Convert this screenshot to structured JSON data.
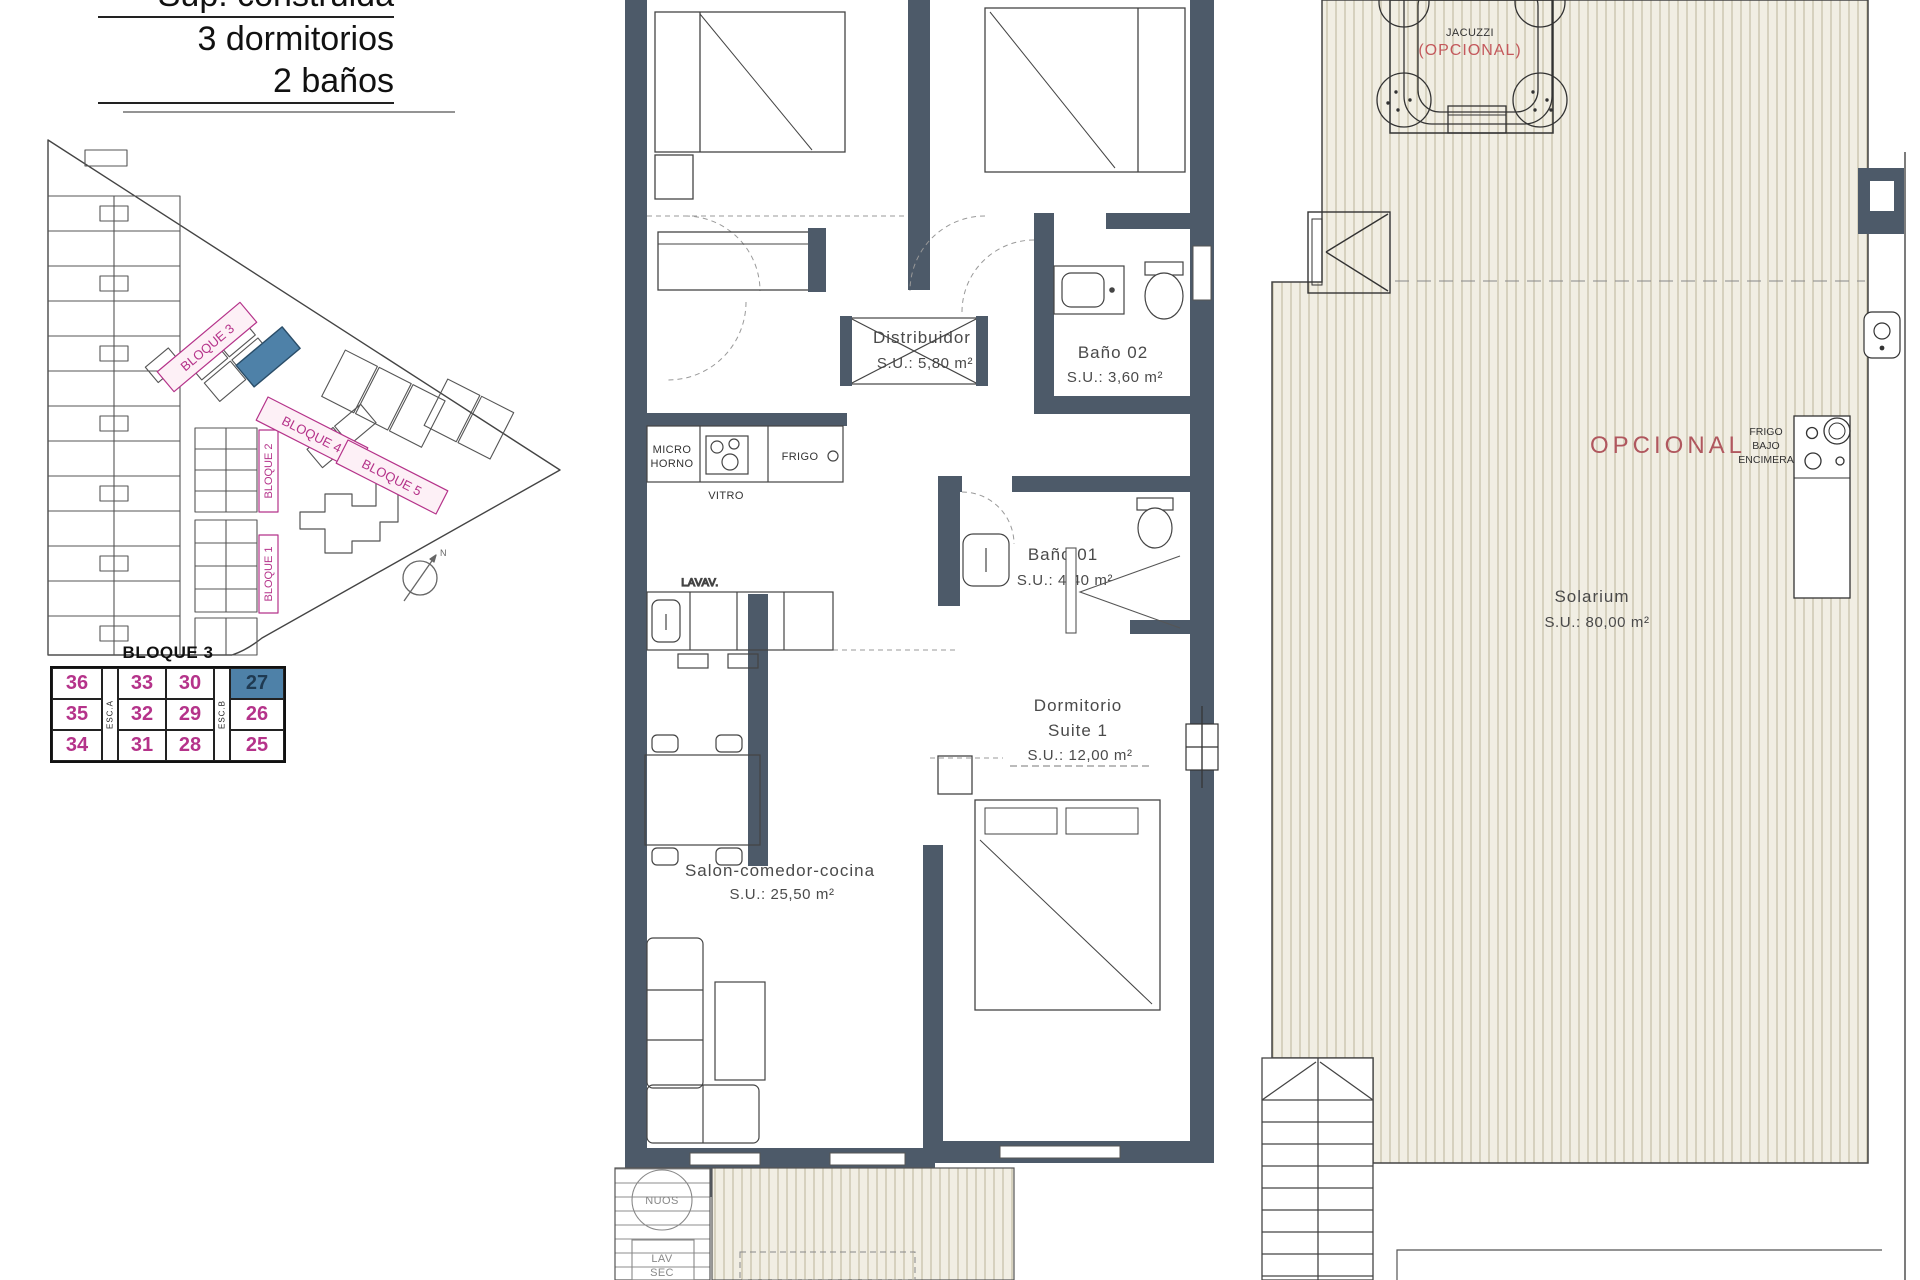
{
  "header": {
    "line1": "Sup. construida",
    "line2": "3 dormitorios",
    "line3": "2 baños"
  },
  "site_plan": {
    "bloque1": "BLOQUE 1",
    "bloque2": "BLOQUE 2",
    "bloque3": "BLOQUE 3",
    "bloque4": "BLOQUE 4",
    "bloque5": "BLOQUE 5",
    "north": "N"
  },
  "unit_table": {
    "title": "BLOQUE 3",
    "stair_a": "ESC.A",
    "stair_b": "ESC.B",
    "col1": [
      "36",
      "35",
      "34"
    ],
    "col2": [
      "33",
      "32",
      "31"
    ],
    "col3": [
      "30",
      "29",
      "28"
    ],
    "col4": [
      "27",
      "26",
      "25"
    ],
    "highlighted_unit": "27"
  },
  "floor_plan": {
    "distribuidor_name": "Distribuidor",
    "distribuidor_area": "S.U.: 5,80 m²",
    "bano02_name": "Baño 02",
    "bano02_area": "S.U.: 3,60 m²",
    "bano01_name": "Baño 01",
    "bano01_area": "S.U.: 4,40 m²",
    "suite_name": "Dormitorio",
    "suite_name2": "Suite 1",
    "suite_area": "S.U.: 12,00 m²",
    "salon_name": "Salon-comedor-cocina",
    "salon_area": "S.U.: 25,50 m²",
    "kitchen": {
      "micro1": "MICRO",
      "micro2": "HORNO",
      "vitro": "VITRO",
      "frigo": "FRIGO",
      "lavav": "LAVAV."
    },
    "utility": {
      "nuos": "NUOS",
      "lav": "LAV",
      "sec": "SEC"
    }
  },
  "solarium": {
    "name": "Solarium",
    "area": "S.U.: 80,00 m²",
    "opcional": "OPCIONAL",
    "frigo1": "FRIGO",
    "frigo2": "BAJO",
    "frigo3": "ENCIMERA",
    "jacuzzi": "JACUZZI",
    "jacuzzi_opt": "(OPCIONAL)"
  },
  "colors": {
    "wall": "#4d5a69",
    "magenta": "#b5338a",
    "highlight_blue": "#4e81a8",
    "opcional_red": "#b0575e",
    "deck_bg": "#f1eee3",
    "deck_line": "#bcb498"
  }
}
